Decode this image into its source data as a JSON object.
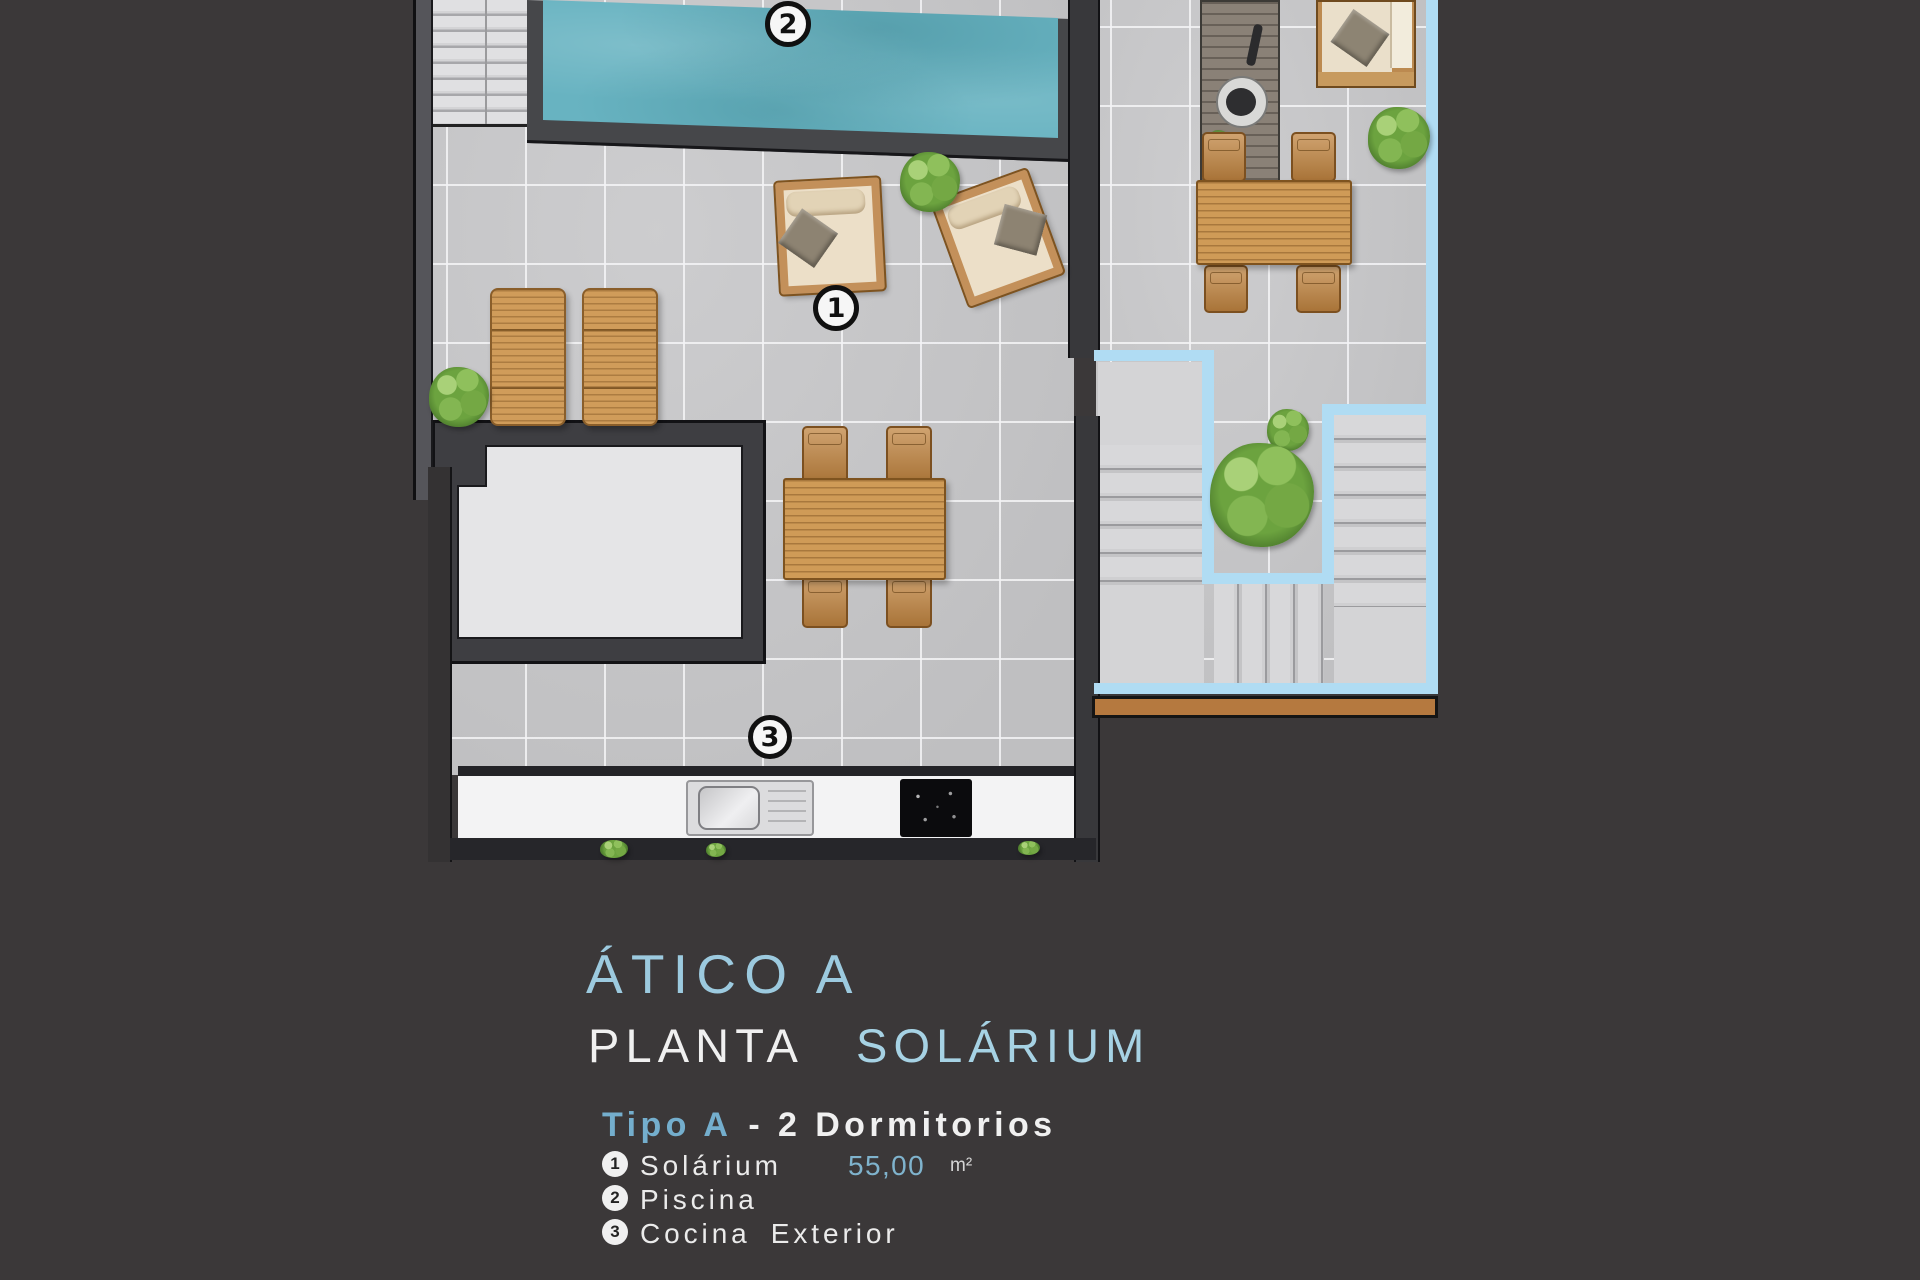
{
  "title": {
    "name": "ÁTICO A",
    "line2_primary": "PLANTA",
    "line2_accent": "SOLÁRIUM",
    "type_accent": "Tipo A",
    "type_rest": "- 2 Dormitorios"
  },
  "legend": {
    "items": [
      {
        "num": "1",
        "label": "Solárium",
        "area": "55,00",
        "unit": "m²"
      },
      {
        "num": "2",
        "label": "Piscina",
        "area": "",
        "unit": ""
      },
      {
        "num": "3",
        "label": "Cocina Exterior",
        "area": "",
        "unit": ""
      }
    ]
  },
  "plan": {
    "markers": [
      {
        "num": "1",
        "meaning": "Solárium"
      },
      {
        "num": "2",
        "meaning": "Piscina"
      },
      {
        "num": "3",
        "meaning": "Cocina Exterior"
      }
    ]
  },
  "colors": {
    "background": "#3b3839",
    "tile": "#c9c9cb",
    "pool_water": "#68b3c1",
    "boundary_blue": "#b0dcf3",
    "accent_text_blue": "#9ccadf",
    "wood": "#cf9b57"
  }
}
